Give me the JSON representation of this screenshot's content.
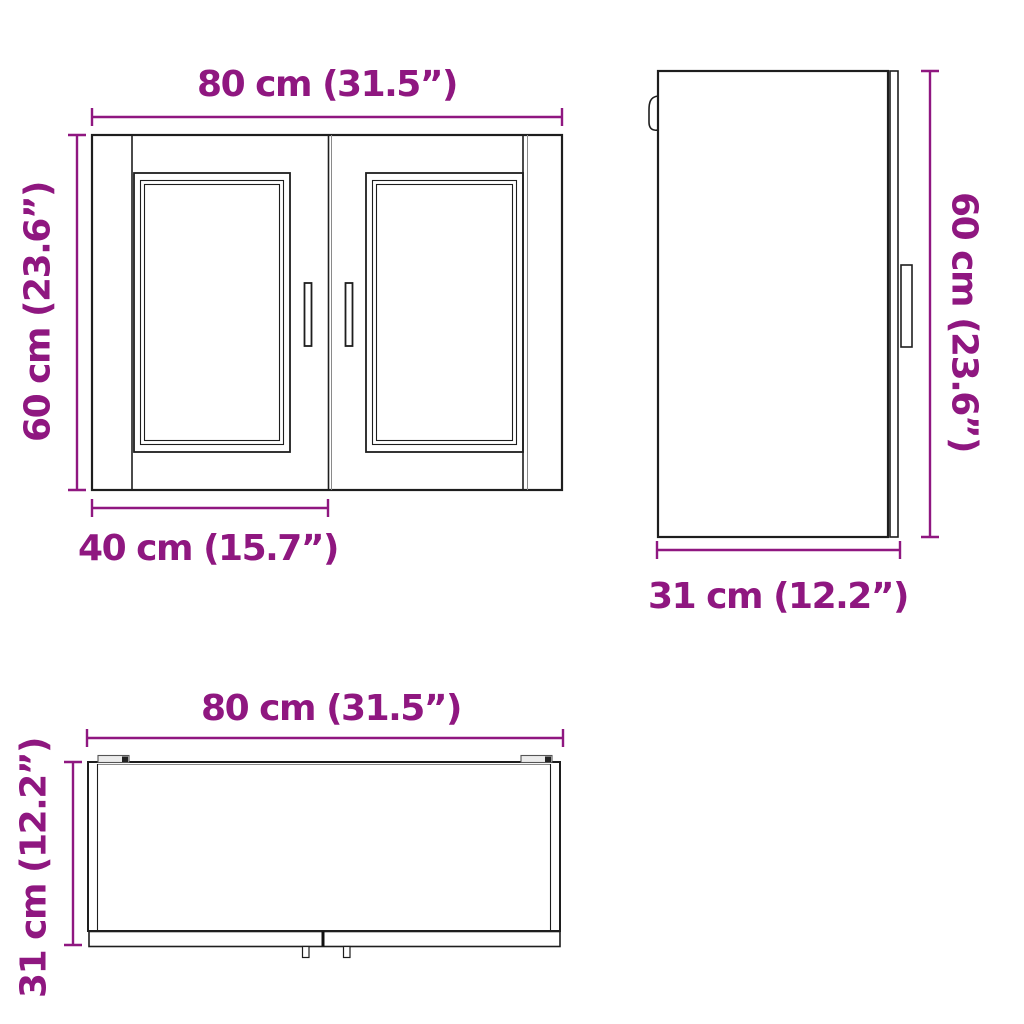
{
  "page": {
    "type": "product-dimension-diagram",
    "subject": "kitchen wall cabinet with two glass doors",
    "background_color": "#ffffff"
  },
  "colors": {
    "dimension_accent": "#8f1780",
    "drawing_line": "#1e1e1e"
  },
  "front_view": {
    "width_label": "80 cm (31.5”)",
    "height_label": "60 cm (23.6”)",
    "door_width_label": "40 cm (15.7”)"
  },
  "side_view": {
    "height_label": "60 cm (23.6”)",
    "depth_label": "31 cm (12.2”)"
  },
  "top_view": {
    "width_label": "80 cm (31.5”)",
    "depth_label": "31 cm (12.2”)"
  },
  "values": {
    "width_cm": 80,
    "width_in": 31.5,
    "height_cm": 60,
    "height_in": 23.6,
    "depth_cm": 31,
    "depth_in": 12.2,
    "door_width_cm": 40,
    "door_width_in": 15.7
  }
}
